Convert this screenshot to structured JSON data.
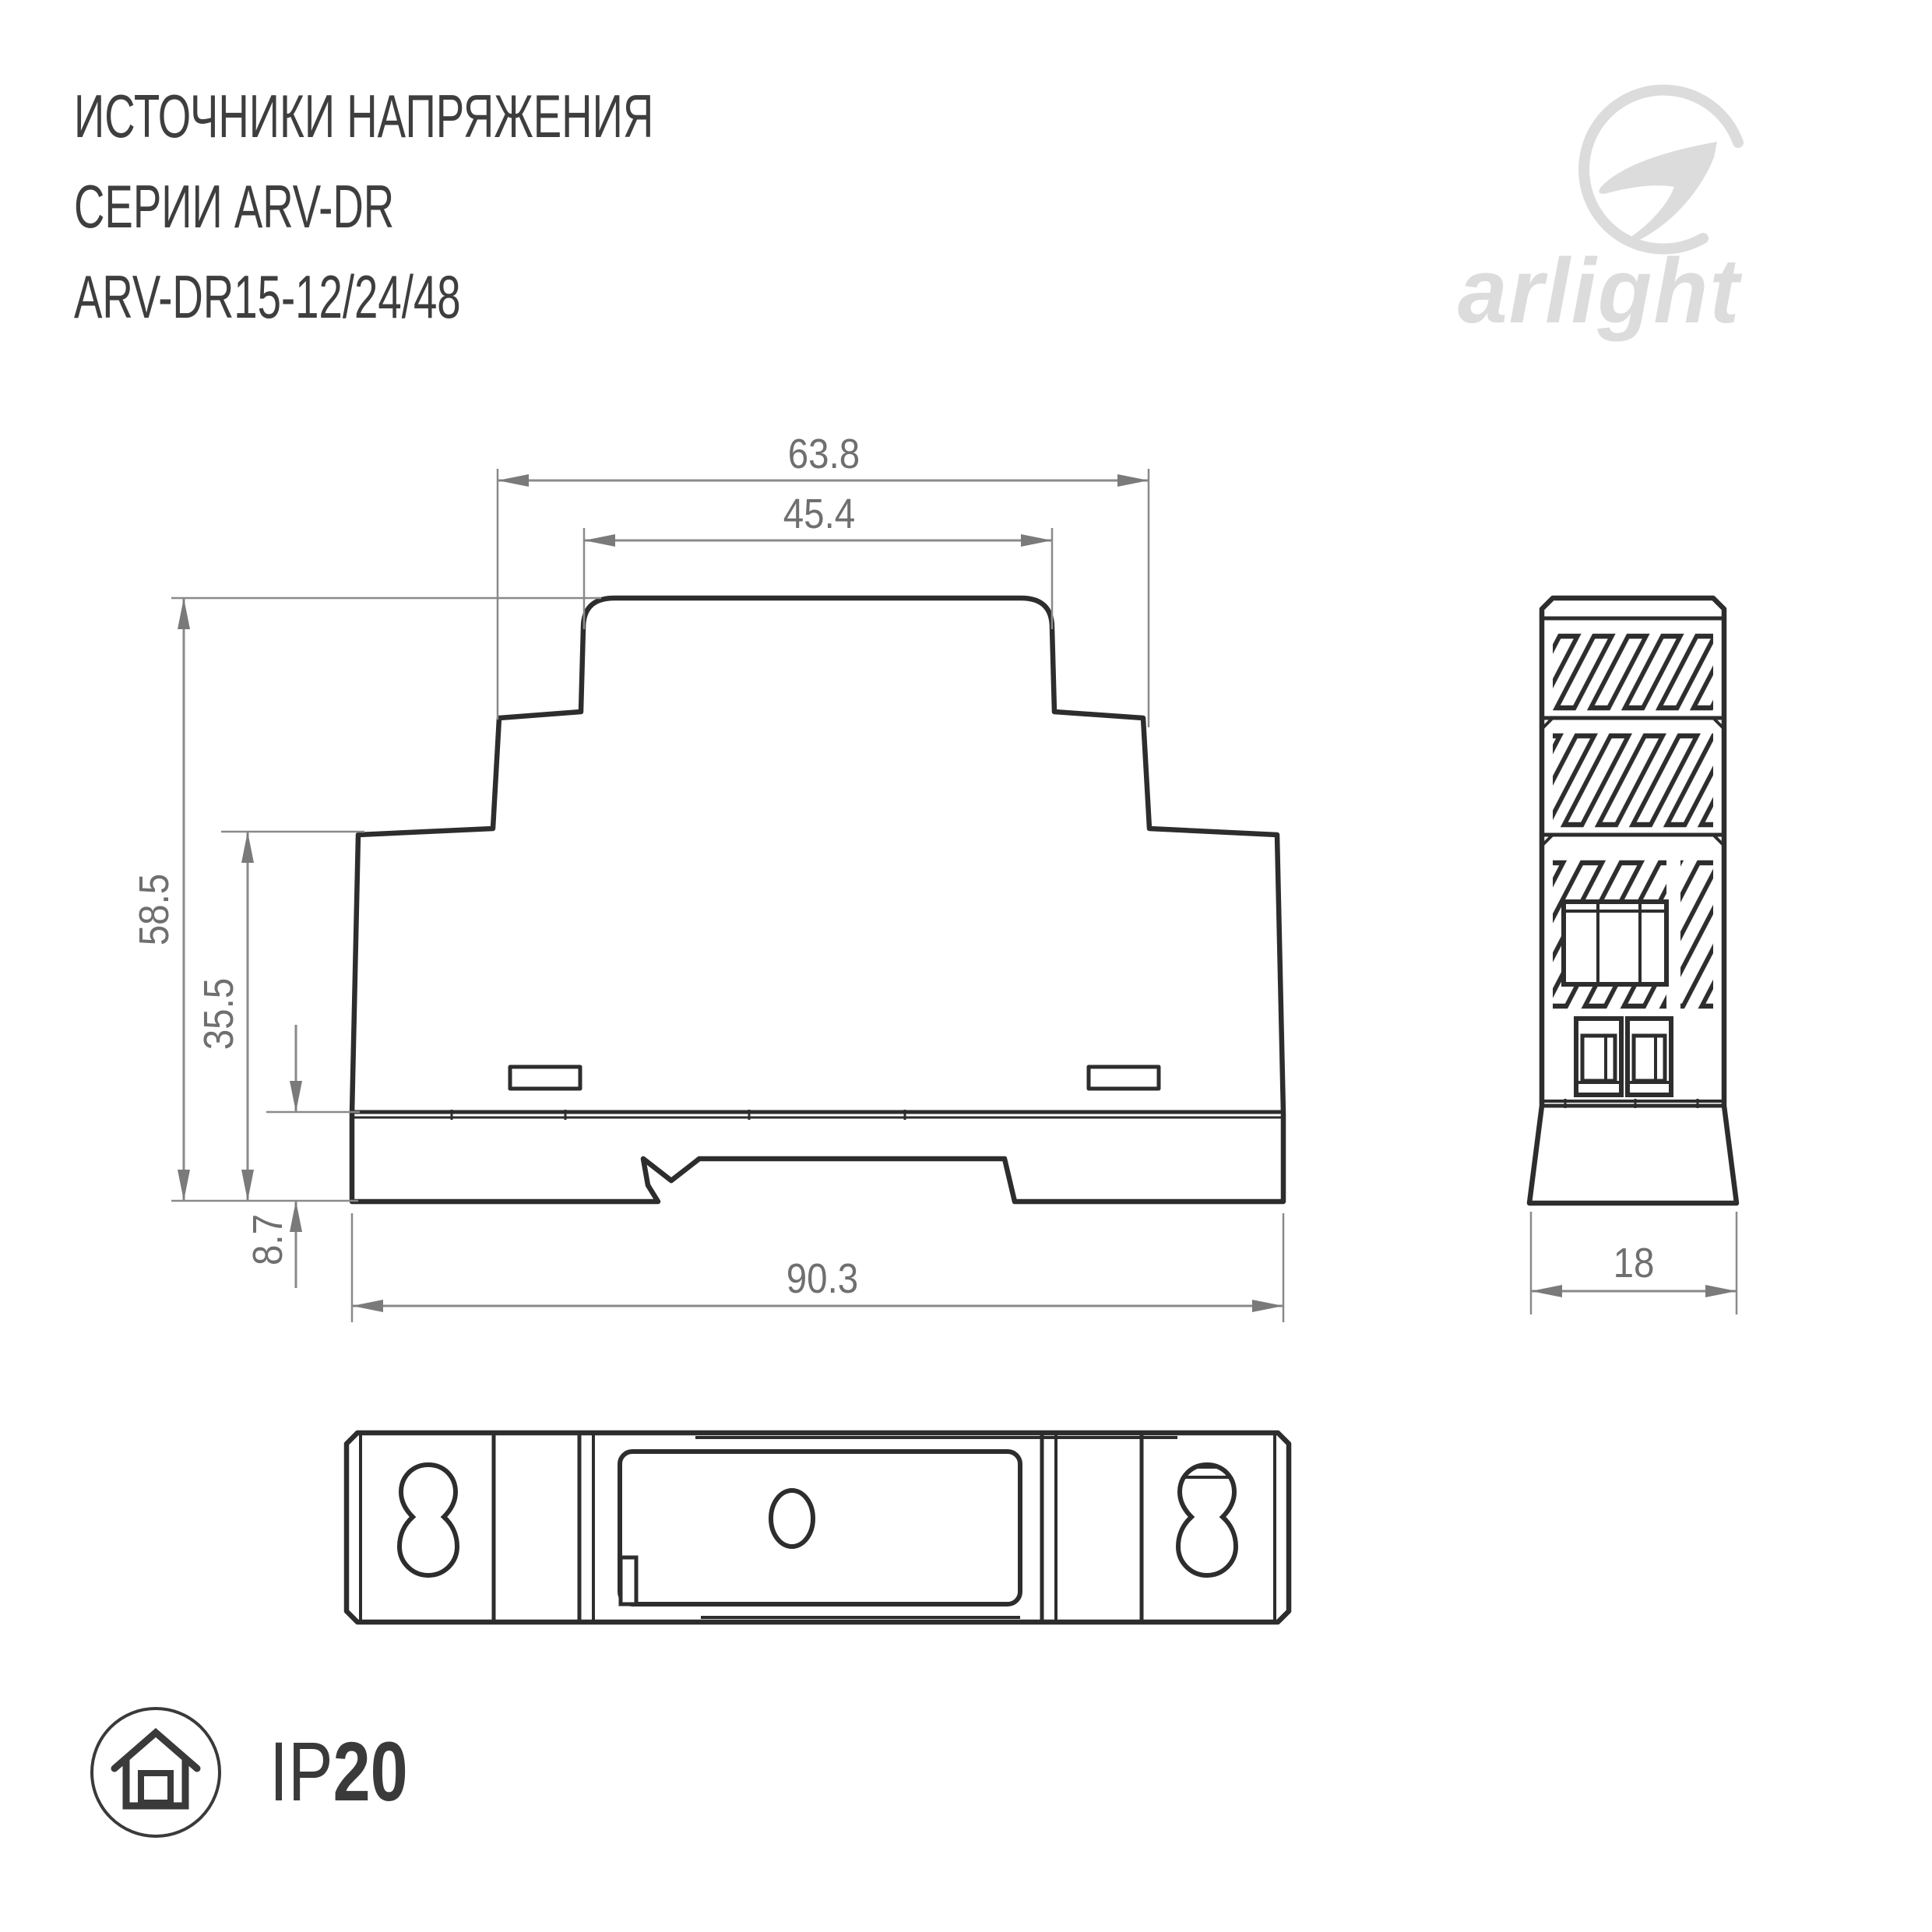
{
  "header": {
    "title_line1": "ИСТОЧНИКИ НАПРЯЖЕНИЯ",
    "title_line2": "СЕРИИ ARV-DR",
    "title_line3": "ARV-DR15-12/24/48"
  },
  "logo": {
    "text": "arlight"
  },
  "drawing": {
    "dimensions": {
      "upper_width": "63.8",
      "cap_width": "45.4",
      "total_height": "58.5",
      "body_height": "35.5",
      "base_height": "8.7",
      "total_width": "90.3",
      "depth": "18"
    }
  },
  "footer": {
    "ip_prefix": "IP",
    "ip_rating": "20"
  },
  "colors": {
    "outline": "#2d2d2d",
    "dimension_gray": "#7a7a7a",
    "title_gray": "#3e3e3e",
    "logo_gray": "#dcdcdc",
    "ip_dark": "#3a3a3a",
    "background": "#ffffff"
  }
}
